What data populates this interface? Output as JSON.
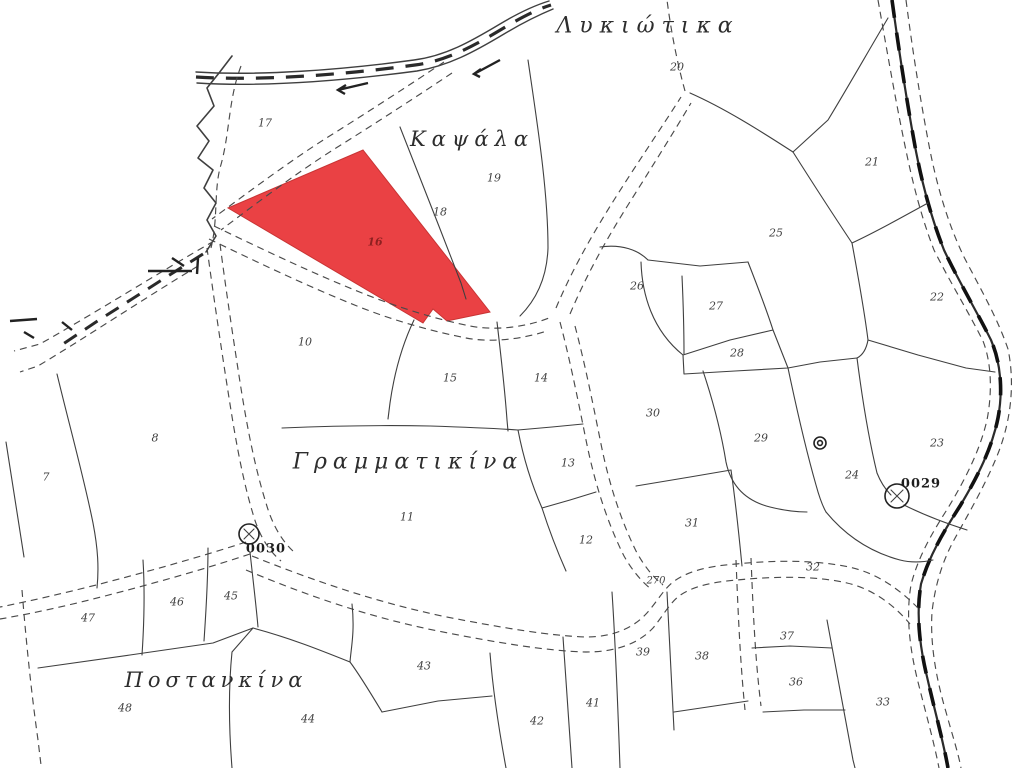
{
  "map": {
    "background": "#ffffff",
    "line_color": "#3f3f3f",
    "highlight": {
      "fill": "#ea4144",
      "number": "16",
      "number_color": "#8e2020"
    },
    "labels": [
      {
        "type": "place",
        "text": "Λυκιώτικα",
        "x": 648,
        "y": 26,
        "fs": 22,
        "ls": 7
      },
      {
        "type": "place",
        "text": "Καψάλα",
        "x": 472,
        "y": 139,
        "fs": 21,
        "ls": 6
      },
      {
        "type": "place",
        "text": "Γραμματικίνα",
        "x": 408,
        "y": 462,
        "fs": 22,
        "ls": 6
      },
      {
        "type": "place",
        "text": "Ποστανκίνα",
        "x": 216,
        "y": 680,
        "fs": 21,
        "ls": 5
      },
      {
        "type": "parcel",
        "text": "20",
        "x": 677,
        "y": 67
      },
      {
        "type": "parcel",
        "text": "17",
        "x": 265,
        "y": 123
      },
      {
        "type": "parcel",
        "text": "19",
        "x": 494,
        "y": 178
      },
      {
        "type": "parcel",
        "text": "18",
        "x": 440,
        "y": 212
      },
      {
        "type": "parcel",
        "text": "21",
        "x": 872,
        "y": 162
      },
      {
        "type": "parcel",
        "text": "25",
        "x": 776,
        "y": 233
      },
      {
        "type": "parcel",
        "text": "26",
        "x": 637,
        "y": 286
      },
      {
        "type": "parcel",
        "text": "27",
        "x": 716,
        "y": 306
      },
      {
        "type": "parcel",
        "text": "22",
        "x": 937,
        "y": 297
      },
      {
        "type": "parcel",
        "text": "28",
        "x": 737,
        "y": 353
      },
      {
        "type": "parcel",
        "text": "10",
        "x": 305,
        "y": 342
      },
      {
        "type": "parcel",
        "text": "15",
        "x": 450,
        "y": 378
      },
      {
        "type": "parcel",
        "text": "14",
        "x": 541,
        "y": 378
      },
      {
        "type": "parcel",
        "text": "30",
        "x": 653,
        "y": 413
      },
      {
        "type": "parcel",
        "text": "29",
        "x": 761,
        "y": 438
      },
      {
        "type": "parcel",
        "text": "23",
        "x": 937,
        "y": 443
      },
      {
        "type": "parcel",
        "text": "24",
        "x": 852,
        "y": 475
      },
      {
        "type": "parcel",
        "text": "13",
        "x": 568,
        "y": 463
      },
      {
        "type": "parcel",
        "text": "8",
        "x": 155,
        "y": 438
      },
      {
        "type": "parcel",
        "text": "7",
        "x": 46,
        "y": 477
      },
      {
        "type": "parcel",
        "text": "11",
        "x": 407,
        "y": 517
      },
      {
        "type": "parcel",
        "text": "31",
        "x": 692,
        "y": 523
      },
      {
        "type": "parcel",
        "text": "12",
        "x": 586,
        "y": 540
      },
      {
        "type": "parcel",
        "text": "32",
        "x": 813,
        "y": 567
      },
      {
        "type": "parcel",
        "text": "47",
        "x": 88,
        "y": 618
      },
      {
        "type": "parcel",
        "text": "46",
        "x": 177,
        "y": 602
      },
      {
        "type": "parcel",
        "text": "45",
        "x": 231,
        "y": 596
      },
      {
        "type": "parcel",
        "text": "48",
        "x": 125,
        "y": 708
      },
      {
        "type": "parcel",
        "text": "44",
        "x": 308,
        "y": 719
      },
      {
        "type": "parcel",
        "text": "43",
        "x": 424,
        "y": 666
      },
      {
        "type": "parcel",
        "text": "42",
        "x": 537,
        "y": 721
      },
      {
        "type": "parcel",
        "text": "41",
        "x": 593,
        "y": 703
      },
      {
        "type": "parcel",
        "text": "39",
        "x": 643,
        "y": 652
      },
      {
        "type": "parcel",
        "text": "38",
        "x": 702,
        "y": 656
      },
      {
        "type": "parcel",
        "text": "37",
        "x": 787,
        "y": 636
      },
      {
        "type": "parcel",
        "text": "36",
        "x": 796,
        "y": 682
      },
      {
        "type": "parcel",
        "text": "33",
        "x": 883,
        "y": 702
      },
      {
        "type": "road",
        "text": "270",
        "x": 656,
        "y": 581
      },
      {
        "type": "marker",
        "text": "0029",
        "x": 921,
        "y": 484
      },
      {
        "type": "marker",
        "text": "0030",
        "x": 266,
        "y": 549
      },
      {
        "type": "parcel-red",
        "text": "16",
        "x": 375,
        "y": 242
      }
    ]
  }
}
